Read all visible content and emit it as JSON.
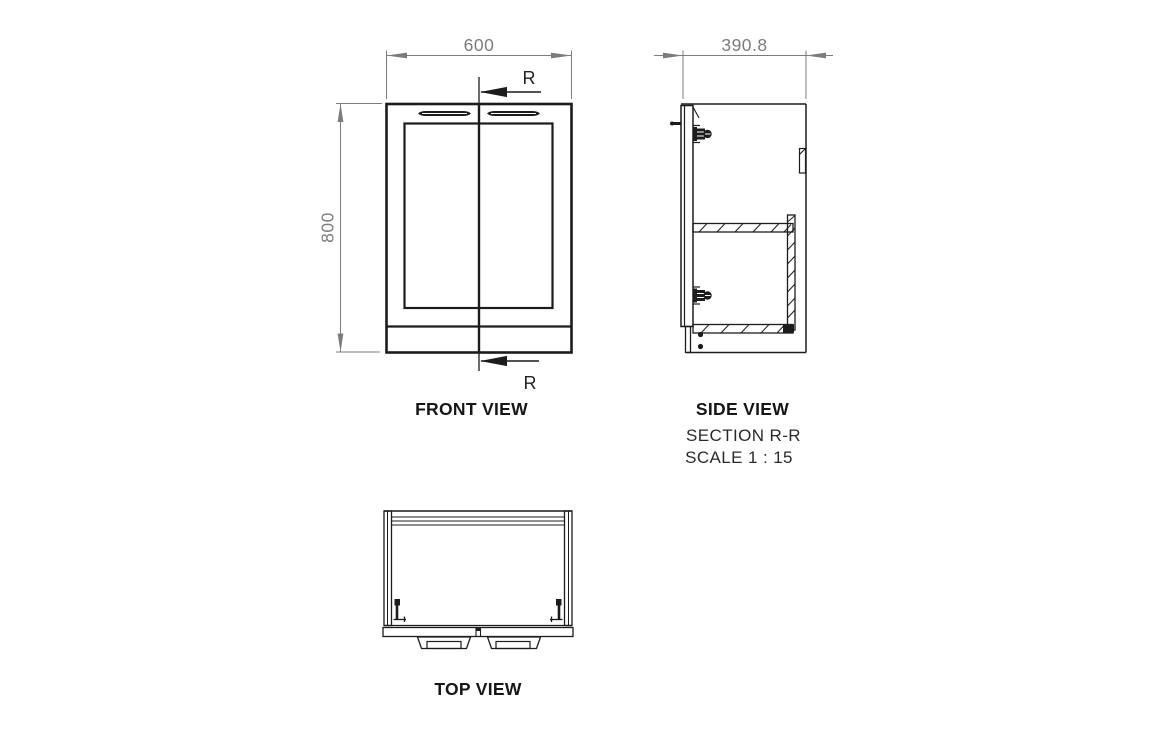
{
  "views": {
    "front": {
      "label": "FRONT VIEW"
    },
    "side": {
      "label": "SIDE VIEW",
      "section_label": "SECTION R-R",
      "scale_label": "SCALE 1 : 15"
    },
    "top": {
      "label": "TOP VIEW"
    }
  },
  "dimensions": {
    "width_mm": "600",
    "height_mm": "800",
    "depth_mm": "390.8"
  },
  "section_marker": "R",
  "colors": {
    "line": "#1c1c1c",
    "dimension": "#7c7c7c",
    "background": "#ffffff"
  }
}
